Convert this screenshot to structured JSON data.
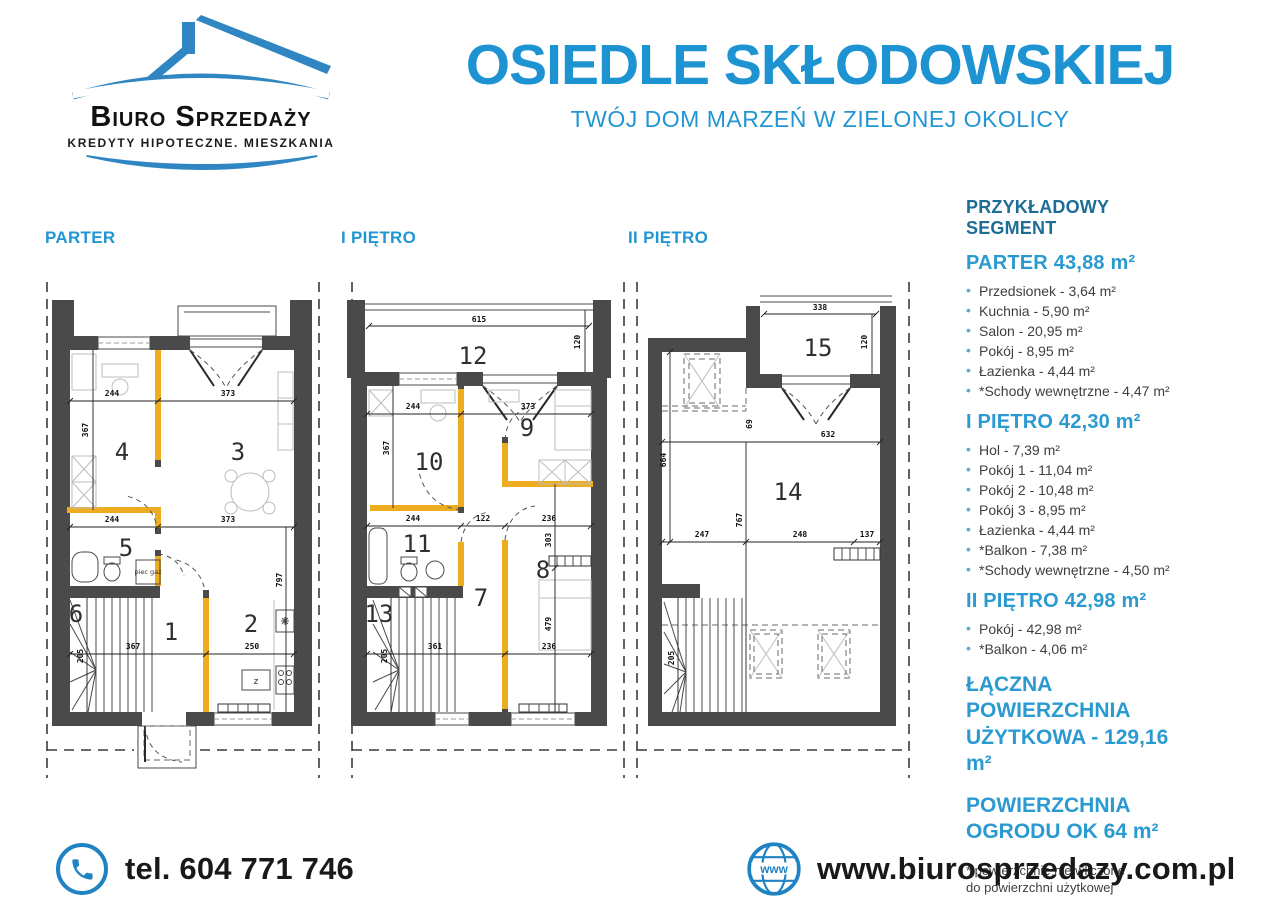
{
  "colors": {
    "accent": "#2196d3",
    "accent_dark": "#1d6d96",
    "logo_blue": "#2f86c3",
    "wall_gray": "#4a4a4a",
    "partition_yellow": "#eead20",
    "text": "#3f3f3f"
  },
  "logo": {
    "name": "Biuro Sprzedaży",
    "tagline": "KREDYTY HIPOTECZNE. MIESZKANIA"
  },
  "header": {
    "title": "OSIEDLE SKŁODOWSKIEJ",
    "subtitle": "TWÓJ DOM MARZEŃ W ZIELONEJ OKOLICY"
  },
  "plans": {
    "parter": {
      "label": "PARTER",
      "rooms": [
        "1",
        "2",
        "3",
        "4",
        "5",
        "6"
      ],
      "dims": {
        "w_top_left": "244",
        "w_top_right": "373",
        "h_left": "367",
        "w_mid_left": "244",
        "w_mid_right": "373",
        "h_right": "797",
        "h_stairs": "205",
        "w_bottom_left": "367",
        "w_bottom_right": "250"
      },
      "annotations": {
        "stove": "piec gaz",
        "z": "z"
      }
    },
    "pietro1": {
      "label": "I PIĘTRO",
      "rooms": [
        "7",
        "8",
        "9",
        "10",
        "11",
        "12",
        "13"
      ],
      "dims": {
        "balcony_w": "615",
        "balcony_d": "120",
        "w_top_left": "244",
        "w_top_right": "373",
        "h_left": "367",
        "w_mid_left": "244",
        "w_mid_mid": "122",
        "w_mid_right": "236",
        "h_right_top": "303",
        "h_right_bottom": "479",
        "h_stairs": "205",
        "w_bottom_left": "361",
        "w_bottom_right": "236"
      }
    },
    "pietro2": {
      "label": "II PIĘTRO",
      "rooms": [
        "14",
        "15"
      ],
      "dims": {
        "balcony_w": "338",
        "balcony_d": "120",
        "h_left": "664",
        "w_top": "632",
        "h_mid": "767",
        "w_low_left": "247",
        "w_low_mid": "248",
        "w_low_right": "137",
        "h_stairs": "205",
        "knee": "69"
      }
    }
  },
  "panel": {
    "title": "PRZYKŁADOWY SEGMENT",
    "sections": [
      {
        "heading": "PARTER 43,88 m²",
        "items": [
          "Przedsionek - 3,64 m²",
          "Kuchnia - 5,90 m²",
          "Salon - 20,95 m²",
          "Pokój - 8,95 m²",
          "Łazienka - 4,44 m²",
          "*Schody wewnętrzne - 4,47 m²"
        ]
      },
      {
        "heading": "I PIĘTRO 42,30 m²",
        "items": [
          "Hol - 7,39 m²",
          "Pokój 1 - 11,04 m²",
          "Pokój 2 - 10,48 m²",
          "Pokój 3 - 8,95 m²",
          "Łazienka - 4,44 m²",
          "*Balkon - 7,38 m²",
          "*Schody wewnętrzne - 4,50 m²"
        ]
      },
      {
        "heading": "II PIĘTRO 42,98 m²",
        "items": [
          "Pokój - 42,98 m²",
          "*Balkon - 4,06 m²"
        ]
      }
    ],
    "totals": [
      {
        "line1": "ŁĄCZNA POWIERZCHNIA",
        "line2": "UŻYTKOWA - 129,16 m²"
      },
      {
        "line1": "POWIERZCHNIA",
        "line2": "OGRODU OK 64 m²"
      }
    ],
    "footnote": {
      "line1": "* powierzchnie nie wliczone",
      "line2": "do powierzchni użytkowej"
    }
  },
  "footer": {
    "phone": "tel. 604 771 746",
    "website": "www.biurosprzedazy.com.pl",
    "globe_label": "www"
  }
}
